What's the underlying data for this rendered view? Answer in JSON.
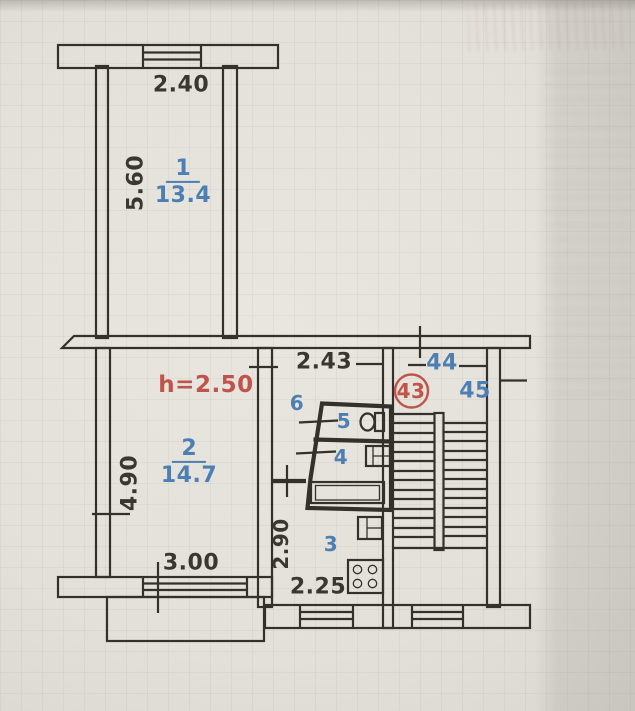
{
  "plan": {
    "rooms": {
      "room1": {
        "number": "1",
        "area": "13.4"
      },
      "room2": {
        "number": "2",
        "area": "14.7"
      },
      "room3": {
        "number": "3"
      },
      "room4": {
        "number": "4"
      },
      "room5": {
        "number": "5"
      },
      "room6": {
        "number": "6"
      }
    },
    "dimensions": {
      "room1_width": "2.40",
      "room1_depth": "5.60",
      "ceiling_height": "h=2.50",
      "hall_width": "2.43",
      "room2_depth": "4.90",
      "room2_window": "3.00",
      "kitchen_depth": "2.90",
      "kitchen_width": "2.25"
    },
    "apartments": {
      "current": "43",
      "left": "44",
      "right": "45"
    }
  },
  "colors": {
    "ink": "#34312c",
    "blue": "#4d7fb2",
    "red": "#c0544a",
    "paper": "#e4e1da"
  }
}
